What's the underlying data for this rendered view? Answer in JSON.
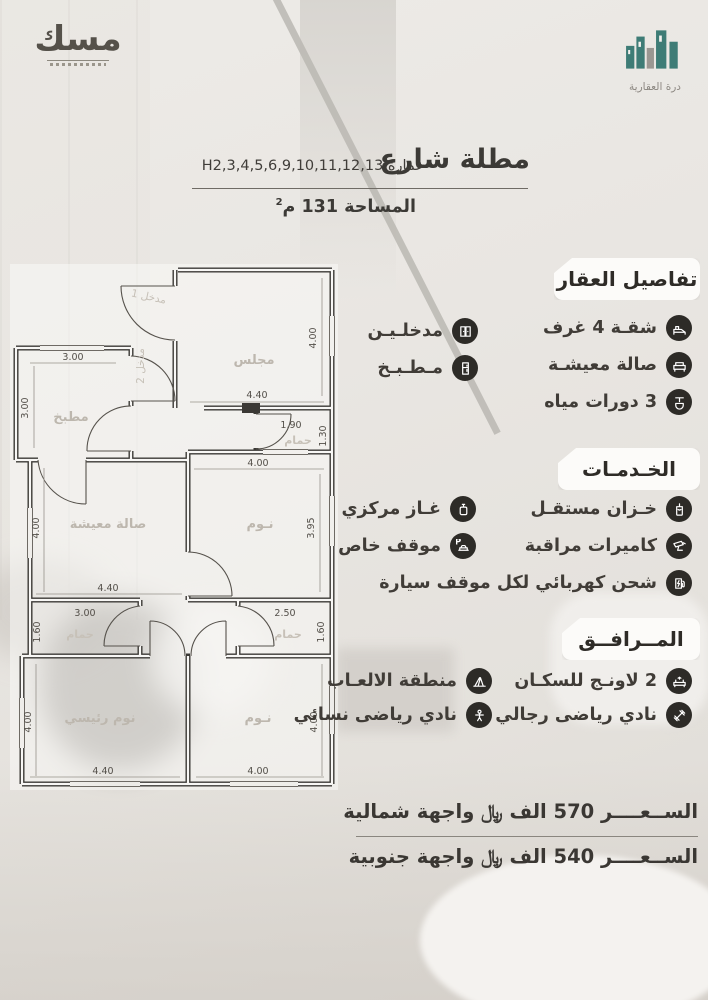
{
  "brand": {
    "misk_logo_text": "مسك",
    "durrah_logo_text": "درة العقارية",
    "teal": "#3E7C76"
  },
  "header": {
    "title": "مطلة شارع",
    "building": "عمارة H2,3,4,5,6,9,10,11,12,13",
    "area_text": "المساحة 131 م",
    "area_sup": "2"
  },
  "details": {
    "title": "تفاصيل العقار",
    "items": [
      {
        "label": "شقـة 4 غرف",
        "icon": "bed-icon"
      },
      {
        "label": "صالة معيشـة",
        "icon": "sofa-icon"
      },
      {
        "label": "3 دورات مياه",
        "icon": "toilet-icon"
      },
      {
        "label": "مدخلـيـن",
        "icon": "door-icon"
      },
      {
        "label": "مـطـبـخ",
        "icon": "kitchen-icon"
      }
    ]
  },
  "services": {
    "title": "الخـدمـات",
    "items": [
      {
        "label": "خـزان مستقـل",
        "icon": "water-tank-icon"
      },
      {
        "label": "كاميرات مراقبة",
        "icon": "cctv-icon"
      },
      {
        "label": "غـاز مركزي",
        "icon": "gas-icon"
      },
      {
        "label": "موقف خاص",
        "icon": "parking-icon"
      },
      {
        "label": "شحن كهربائي لكل موقف سيارة",
        "icon": "ev-charger-icon"
      }
    ]
  },
  "amenities": {
    "title": "المــرافــق",
    "items": [
      {
        "label": "2 لاونـج للسكـان",
        "icon": "lounge-icon"
      },
      {
        "label": "منطقة الالعـاب",
        "icon": "playground-icon"
      },
      {
        "label": "نادي رياضى رجالي",
        "icon": "gym-men-icon"
      },
      {
        "label": "نادي رياضى نسائي",
        "icon": "gym-women-icon"
      }
    ]
  },
  "prices": {
    "north": "الســعــــر 570 الف ﷼ واجهة شمالية",
    "south": "الســعــــر 540 الف ﷼ واجهة جنوبية"
  },
  "floorplan": {
    "rooms": {
      "majlis": "مجلس",
      "kitchen": "مطبخ",
      "living": "صالة معيشة",
      "bedroom": "نـوم",
      "master_bedroom": "نوم رئيسي",
      "bathroom": "حمام",
      "entrance1": "مدخل 1",
      "entrance2": "مدخل 2"
    },
    "dims": {
      "majlis_w": "4.40",
      "majlis_h": "4.00",
      "kitchen_w": "3.00",
      "kitchen_h": "3.00",
      "bath_top_w": "1.90",
      "bath_top_h": "1.30",
      "living_w": "4.40",
      "living_h": "4.00",
      "bed_mid_w": "4.00",
      "bed_mid_h": "3.95",
      "bath_left_w": "3.00",
      "bath_left_h": "1.60",
      "bath_right_w": "2.50",
      "bath_right_h": "1.60",
      "master_w": "4.40",
      "master_h": "4.00",
      "bed_bottom_w": "4.00",
      "bed_bottom_h": "4.00"
    }
  }
}
